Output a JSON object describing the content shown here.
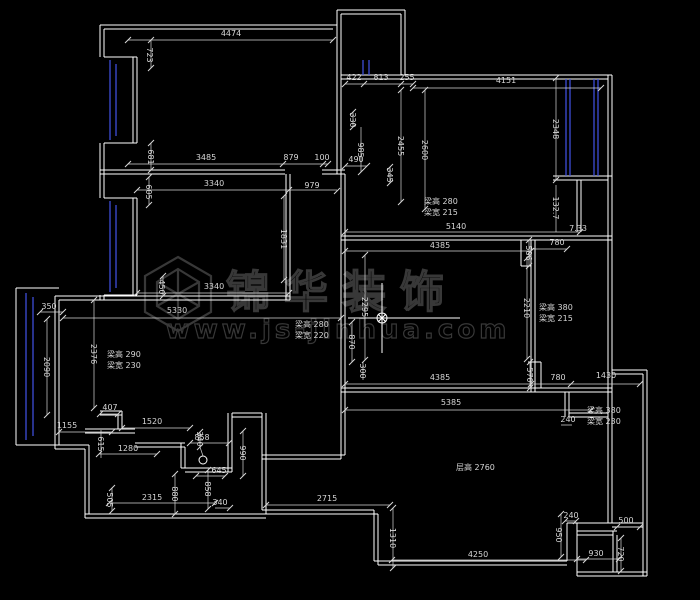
{
  "colors": {
    "bg": "#000000",
    "wall": "#ffffff",
    "window": "#4254e8",
    "dim": "#d6d6d6",
    "watermark": "#383838"
  },
  "drawing": {
    "watermark": {
      "brand": "锦华装饰",
      "url": "www.js-jinhua.com"
    },
    "labels": [
      {
        "t": "4474",
        "x": 231,
        "y": 36
      },
      {
        "t": "3485",
        "x": 206,
        "y": 160
      },
      {
        "t": "879",
        "x": 291,
        "y": 160
      },
      {
        "t": "100",
        "x": 322,
        "y": 160
      },
      {
        "t": "3340",
        "x": 214,
        "y": 186
      },
      {
        "t": "979",
        "x": 312,
        "y": 188
      },
      {
        "t": "422",
        "x": 354,
        "y": 80
      },
      {
        "t": "813",
        "x": 381,
        "y": 80
      },
      {
        "t": "255",
        "x": 407,
        "y": 80
      },
      {
        "t": "4151",
        "x": 506,
        "y": 83
      },
      {
        "t": "490",
        "x": 356,
        "y": 162
      },
      {
        "t": "5140",
        "x": 456,
        "y": 229
      },
      {
        "t": "4385",
        "x": 440,
        "y": 248
      },
      {
        "t": "780",
        "x": 557,
        "y": 245
      },
      {
        "t": "7.33",
        "x": 578,
        "y": 231
      },
      {
        "t": "3340",
        "x": 214,
        "y": 289
      },
      {
        "t": "5330",
        "x": 177,
        "y": 313
      },
      {
        "t": "350",
        "x": 49,
        "y": 309
      },
      {
        "t": "4385",
        "x": 440,
        "y": 380
      },
      {
        "t": "780",
        "x": 558,
        "y": 380
      },
      {
        "t": "1430",
        "x": 606,
        "y": 378
      },
      {
        "t": "5385",
        "x": 451,
        "y": 405
      },
      {
        "t": "240",
        "x": 568,
        "y": 422
      },
      {
        "t": "407",
        "x": 110,
        "y": 410
      },
      {
        "t": "1155",
        "x": 67,
        "y": 428
      },
      {
        "t": "1520",
        "x": 152,
        "y": 424
      },
      {
        "t": "1280",
        "x": 128,
        "y": 451
      },
      {
        "t": "858",
        "x": 202,
        "y": 440
      },
      {
        "t": "645",
        "x": 219,
        "y": 473
      },
      {
        "t": "340",
        "x": 220,
        "y": 505
      },
      {
        "t": "2315",
        "x": 152,
        "y": 500
      },
      {
        "t": "2715",
        "x": 327,
        "y": 501
      },
      {
        "t": "4250",
        "x": 478,
        "y": 557
      },
      {
        "t": "930",
        "x": 596,
        "y": 556
      },
      {
        "t": "240",
        "x": 571,
        "y": 518
      },
      {
        "t": "500",
        "x": 626,
        "y": 523
      },
      {
        "t": "723",
        "x": 147,
        "y": 55,
        "r": 90
      },
      {
        "t": "681",
        "x": 148,
        "y": 157,
        "r": 90
      },
      {
        "t": "605",
        "x": 146,
        "y": 192,
        "r": 90
      },
      {
        "t": "1831",
        "x": 281,
        "y": 239,
        "r": 90
      },
      {
        "t": "450",
        "x": 159,
        "y": 287,
        "r": 90
      },
      {
        "t": "330",
        "x": 350,
        "y": 120,
        "r": 90
      },
      {
        "t": "985",
        "x": 358,
        "y": 150,
        "r": 90
      },
      {
        "t": "345",
        "x": 387,
        "y": 175,
        "r": 90
      },
      {
        "t": "2455",
        "x": 398,
        "y": 146,
        "r": 90
      },
      {
        "t": "2600",
        "x": 422,
        "y": 150,
        "r": 90
      },
      {
        "t": "2348",
        "x": 553,
        "y": 129,
        "r": 90
      },
      {
        "t": "132.7",
        "x": 553,
        "y": 208,
        "r": 90
      },
      {
        "t": "586",
        "x": 526,
        "y": 253,
        "r": 90
      },
      {
        "t": "2295",
        "x": 362,
        "y": 307,
        "r": 90
      },
      {
        "t": "2210",
        "x": 524,
        "y": 308,
        "r": 90
      },
      {
        "t": "870",
        "x": 349,
        "y": 342,
        "r": 90
      },
      {
        "t": "300",
        "x": 360,
        "y": 371,
        "r": 90
      },
      {
        "t": "570",
        "x": 527,
        "y": 375,
        "r": 90
      },
      {
        "t": "2090",
        "x": 44,
        "y": 367,
        "r": 90
      },
      {
        "t": "2376",
        "x": 91,
        "y": 354,
        "r": 90
      },
      {
        "t": "615",
        "x": 98,
        "y": 444,
        "r": 90
      },
      {
        "t": "340",
        "x": 197,
        "y": 439,
        "r": 90
      },
      {
        "t": "990",
        "x": 240,
        "y": 453,
        "r": 90
      },
      {
        "t": "858",
        "x": 205,
        "y": 489,
        "r": 90
      },
      {
        "t": "880",
        "x": 172,
        "y": 494,
        "r": 90
      },
      {
        "t": "505",
        "x": 107,
        "y": 500,
        "r": 90
      },
      {
        "t": "950",
        "x": 556,
        "y": 535,
        "r": 90
      },
      {
        "t": "720",
        "x": 618,
        "y": 554,
        "r": 90
      },
      {
        "t": "1310",
        "x": 390,
        "y": 538,
        "r": 90
      },
      {
        "t": "梁高 280",
        "x": 424,
        "y": 204,
        "a": "s"
      },
      {
        "t": "梁宽 215",
        "x": 424,
        "y": 215,
        "a": "s"
      },
      {
        "t": "梁高 380",
        "x": 539,
        "y": 310,
        "a": "s"
      },
      {
        "t": "梁宽 215",
        "x": 539,
        "y": 321,
        "a": "s"
      },
      {
        "t": "梁高 280",
        "x": 295,
        "y": 327,
        "a": "s"
      },
      {
        "t": "梁宽 220",
        "x": 295,
        "y": 338,
        "a": "s"
      },
      {
        "t": "梁高 290",
        "x": 107,
        "y": 357,
        "a": "s"
      },
      {
        "t": "梁宽 230",
        "x": 107,
        "y": 368,
        "a": "s"
      },
      {
        "t": "梁高 380",
        "x": 587,
        "y": 413,
        "a": "s"
      },
      {
        "t": "梁宽 230",
        "x": 587,
        "y": 424,
        "a": "s"
      },
      {
        "t": "层高 2760",
        "x": 456,
        "y": 470,
        "a": "s"
      }
    ]
  }
}
